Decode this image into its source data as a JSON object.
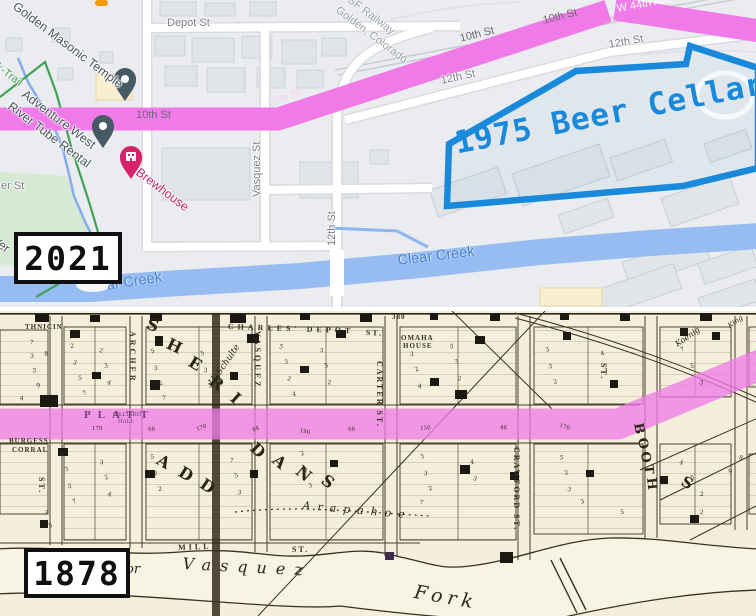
{
  "colors": {
    "route": "#f07be8",
    "route_bottom": "rgba(240,123,232,0.78)",
    "water": "#96bcf2",
    "poly": "#1989dc",
    "park": "#d5e9d3",
    "trail_green": "#41a257",
    "stream": "#85acec",
    "ink": "#3a3020",
    "cream": "#f4efda"
  },
  "top_map": {
    "year": "2021",
    "beer_label": [
      {
        "t": "1975 Beer Cellars",
        "x": 452,
        "y": 128,
        "r": -11,
        "c": "beer"
      }
    ],
    "street_labels": [
      {
        "t": "Depot St",
        "x": 167,
        "y": 18,
        "r": 0
      },
      {
        "t": "10th St",
        "x": 136,
        "y": 110,
        "r": 0,
        "c": "route-dark"
      },
      {
        "t": "10th St",
        "x": 266,
        "y": 100,
        "r": -21,
        "c": "route-light"
      },
      {
        "t": "10th St",
        "x": 459,
        "y": 34,
        "r": -14,
        "c": "route-dark"
      },
      {
        "t": "10th St",
        "x": 542,
        "y": 16,
        "r": -14,
        "c": "route-dark"
      },
      {
        "t": "W 44th Ave",
        "x": 616,
        "y": 4,
        "r": -10,
        "c": "route-white"
      },
      {
        "t": "12th St",
        "x": 440,
        "y": 76,
        "r": -12
      },
      {
        "t": "12th St",
        "x": 608,
        "y": 40,
        "r": -10
      },
      {
        "t": "Vasquez St",
        "x": 252,
        "y": 197,
        "v": -1
      },
      {
        "t": "12th St",
        "x": 327,
        "y": 246,
        "v": -1
      },
      {
        "t": "er St",
        "x": 1,
        "y": 181,
        "r": 0
      },
      {
        "t": "k-Trail",
        "x": 0,
        "y": 62,
        "r": 37,
        "c": "green"
      },
      {
        "t": "Ver",
        "x": -3,
        "y": 234,
        "r": 37,
        "c": "poi"
      }
    ],
    "poi_labels": [
      {
        "t": "Golden Masonic Temple",
        "x": 18,
        "y": 0,
        "r": 37,
        "c": "poi"
      },
      {
        "t": "Adventure West",
        "x": 27,
        "y": 88,
        "r": 37,
        "c": "poi"
      },
      {
        "t": "River Tube Rental",
        "x": 13,
        "y": 100,
        "r": 37,
        "c": "poi"
      },
      {
        "t": "Brewhouse",
        "x": 141,
        "y": 166,
        "r": 37,
        "c": "brew"
      },
      {
        "t": "SF Railway",
        "x": 352,
        "y": -5,
        "r": 37,
        "c": "rail"
      },
      {
        "t": "Golden, Colorado",
        "x": 340,
        "y": 5,
        "r": 37,
        "c": "rail"
      }
    ],
    "water_labels": [
      {
        "t": "Clear Creek",
        "x": 397,
        "y": 254,
        "r": -7,
        "c": "water"
      },
      {
        "t": "ar Creek",
        "x": 106,
        "y": 279,
        "r": -9,
        "c": "water"
      }
    ]
  },
  "bottom_map": {
    "year": "1878",
    "street_labels": [
      {
        "t": "CHARLES' DEPOT",
        "x": 228,
        "y": 323,
        "r": 2,
        "ls": 4
      },
      {
        "t": "ST.",
        "x": 366,
        "y": 329,
        "r": 2
      },
      {
        "t": "380",
        "x": 392,
        "y": 314,
        "s": 7,
        "ls": 1
      },
      {
        "t": "ARCHER",
        "x": 136,
        "y": 331,
        "v": 1,
        "ls": 3
      },
      {
        "t": "VASQUEZ",
        "x": 261,
        "y": 331,
        "v": 1,
        "ls": 3
      },
      {
        "t": "CARTER ST.",
        "x": 383,
        "y": 361,
        "v": 1,
        "ls": 2
      },
      {
        "t": "CRAWFORD ST.",
        "x": 520,
        "y": 447,
        "v": 1,
        "ls": 2
      },
      {
        "t": "ST.",
        "x": 45,
        "y": 477,
        "v": 1
      },
      {
        "t": "ST.",
        "x": 607,
        "y": 363,
        "v": 1
      },
      {
        "t": "MILL",
        "x": 178,
        "y": 544,
        "r": -2,
        "ls": 3
      },
      {
        "t": "ST.",
        "x": 292,
        "y": 546,
        "r": 0
      },
      {
        "t": "PLATT",
        "x": 84,
        "y": 410,
        "r": 0,
        "s": 11,
        "ls": 7,
        "c": "onpink"
      },
      {
        "t": "BILLIARD",
        "x": 113,
        "y": 412,
        "s": 6,
        "c": "onpink2"
      },
      {
        "t": "HALL",
        "x": 118,
        "y": 419,
        "s": 6,
        "c": "onpink2"
      }
    ],
    "place_labels": [
      {
        "t": "OMAHA",
        "x": 401,
        "y": 335,
        "s": 7,
        "ls": 1
      },
      {
        "t": "HOUSE",
        "x": 403,
        "y": 343,
        "s": 7,
        "ls": 1
      },
      {
        "t": "THNICIN",
        "x": 25,
        "y": 324,
        "s": 7,
        "ls": 1
      },
      {
        "t": "BURGESS",
        "x": 9,
        "y": 438,
        "s": 7,
        "ls": 1
      },
      {
        "t": "CORRAL",
        "x": 12,
        "y": 447,
        "s": 7,
        "ls": 1
      },
      {
        "t": "U. Schulte",
        "x": 208,
        "y": 382,
        "r": -55,
        "s": 9,
        "c": "script"
      },
      {
        "t": "Koenig",
        "x": 674,
        "y": 342,
        "r": -35,
        "s": 8,
        "c": "script"
      },
      {
        "t": "King",
        "x": 727,
        "y": 324,
        "r": -35,
        "s": 7,
        "c": "script"
      },
      {
        "t": "Arapahoe",
        "x": 303,
        "y": 500,
        "r": 5,
        "s": 11,
        "ls": 7,
        "c": "script"
      }
    ],
    "water_labels": [
      {
        "t": "or",
        "x": 126,
        "y": 563,
        "s": 13,
        "c": "river"
      },
      {
        "t": "Vasquez",
        "x": 183,
        "y": 556,
        "r": 3,
        "s": 16,
        "ls": 9,
        "c": "river"
      },
      {
        "t": "Fork",
        "x": 416,
        "y": 583,
        "r": 10,
        "s": 19,
        "ls": 5,
        "c": "river"
      }
    ],
    "big_letters": [
      {
        "t": "S",
        "x": 150,
        "y": 316,
        "r": 20
      },
      {
        "t": "H",
        "x": 171,
        "y": 336,
        "r": 26
      },
      {
        "t": "E",
        "x": 194,
        "y": 354,
        "r": 32
      },
      {
        "t": "R",
        "x": 216,
        "y": 373,
        "r": 38
      },
      {
        "t": "I",
        "x": 238,
        "y": 390,
        "r": 42
      },
      {
        "t": "D",
        "x": 258,
        "y": 440,
        "r": 44
      },
      {
        "t": "A",
        "x": 280,
        "y": 452,
        "r": 42
      },
      {
        "t": "N",
        "x": 303,
        "y": 463,
        "r": 40
      },
      {
        "t": "S",
        "x": 328,
        "y": 472,
        "r": 38
      },
      {
        "t": "A",
        "x": 162,
        "y": 452,
        "r": 30
      },
      {
        "t": "D",
        "x": 184,
        "y": 464,
        "r": 32
      },
      {
        "t": "D",
        "x": 206,
        "y": 476,
        "r": 34
      },
      {
        "t": "B",
        "x": 644,
        "y": 422,
        "r": 80,
        "s": 13
      },
      {
        "t": "O",
        "x": 648,
        "y": 437,
        "r": 82,
        "s": 13
      },
      {
        "t": "O",
        "x": 651,
        "y": 451,
        "r": 84,
        "s": 13
      },
      {
        "t": "T",
        "x": 654,
        "y": 464,
        "r": 84,
        "s": 13
      },
      {
        "t": "H",
        "x": 657,
        "y": 477,
        "r": 84,
        "s": 13
      },
      {
        "t": "S",
        "x": 686,
        "y": 474,
        "r": 30,
        "s": 15
      }
    ],
    "dims_numbers": "170@92,427;66@148,428;170@196,428;84@252,429;190@300,429;66@348,428;150@420,427;46@500,426;170@560,424",
    "lot_numbers": "7@30,340;3@30,354;5@33,368;9@36,384;4@20,396;8@44,352;2@70,344;3@74,360;5@78,376;7@82,392;2@100,348;3@104,364;4@108,380;5@150,350;3@154,366;2@158,382;7@162,396;5@200,352;3@204,368;2@208,384;5@280,344;3@284,360;2@288,376;4@292,392;3@320,348;5@324,364;2@328,380;3@410,352;2@414,368;4@418,384;5@450,344;3@454,360;2@458,376;3@545,348;5@549,364;2@553,380;4@600,352;3@604,368;7@680,348;5@690,364;3@700,380;2@60,452;3@64,468;5@68,484;7@72,500;3@100,460;2@104,476;4@108,492;5@150,455;3@154,471;2@158,487;7@230,458;5@234,474;3@238,490;2@300,452;4@304,468;3@308,484;5@420,455;3@424,471;2@428,487;4@470,460;3@474,476;5@560,455;2@564,471;3@568,487;4@680,460;5@690,476;2@700,492;3@45,510;5@48,524;7@420,500;3@580,500;5@620,510;2@700,510;9@728,470;8@740,455"
  }
}
